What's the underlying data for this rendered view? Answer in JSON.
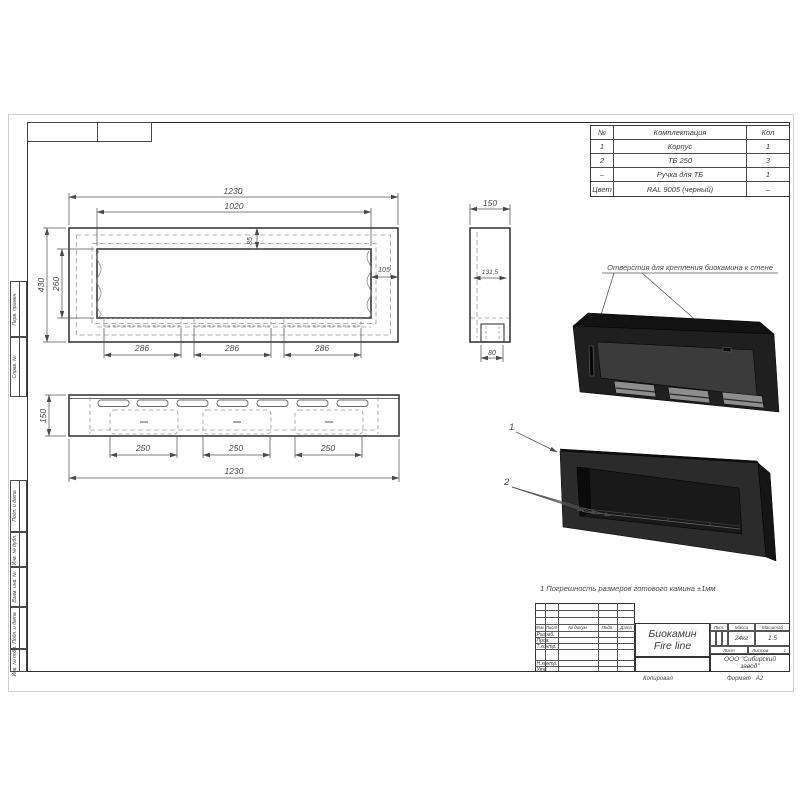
{
  "colors": {
    "line": "#3a3a3a",
    "dim": "#555555",
    "hidden": "#9a9a9a",
    "body_black": "#1f1f1f",
    "steel": "#8d8d8d"
  },
  "frame": {
    "copied_label": "Копировал",
    "format_label": "Формат",
    "format_value": "А2",
    "side_labels": [
      "Перв. примен.",
      "Справ. №",
      "Подп. и дата",
      "Инв. № дубл.",
      "Взам. инв. №",
      "Подп. и дата",
      "Инв. № подл."
    ]
  },
  "parts_table": {
    "headers": [
      "№",
      "Комплектация",
      "Кол"
    ],
    "rows": [
      [
        "1",
        "Корпус",
        "1"
      ],
      [
        "2",
        "ТБ 250",
        "3"
      ],
      [
        "–",
        "Ручка для ТБ",
        "1"
      ],
      [
        "Цвет",
        "RAL 9005 (черный)",
        "–"
      ]
    ]
  },
  "dims": {
    "d1230": "1230",
    "d1020": "1020",
    "d85": "85",
    "d105": "105",
    "d260": "260",
    "d430": "430",
    "d286": "286",
    "d150": "150",
    "d131_5": "131,5",
    "d80": "80",
    "d250": "250"
  },
  "annotations": {
    "mounting_holes": "Отверстия для крепления биокамина к стене",
    "note": "1 Погрешность размеров готового камина ±1мм",
    "callout_1": "1",
    "callout_2": "2"
  },
  "title_block": {
    "doc_name_line1": "Биокамин",
    "doc_name_line2": "Fire line",
    "company_line1": "ООО \"Сибирский",
    "company_line2": "завод\"",
    "header": {
      "izm": "Изм.",
      "list": "Лист",
      "ndoc": "№ докум.",
      "podp": "Подп.",
      "data": "Дата"
    },
    "rows": {
      "razrab": "Разраб.",
      "prov": "Пров.",
      "tkontr": "Т.контр.",
      "nkontr": "Н.контр.",
      "utv": "Утв."
    },
    "lit_label": "Лит.",
    "mass_label": "Масса",
    "scale_label": "Масштаб",
    "mass_value": "24кг",
    "scale_value": "1:5",
    "sheet_label": "Лист",
    "sheets_label": "Листов",
    "sheets_value": "1"
  }
}
